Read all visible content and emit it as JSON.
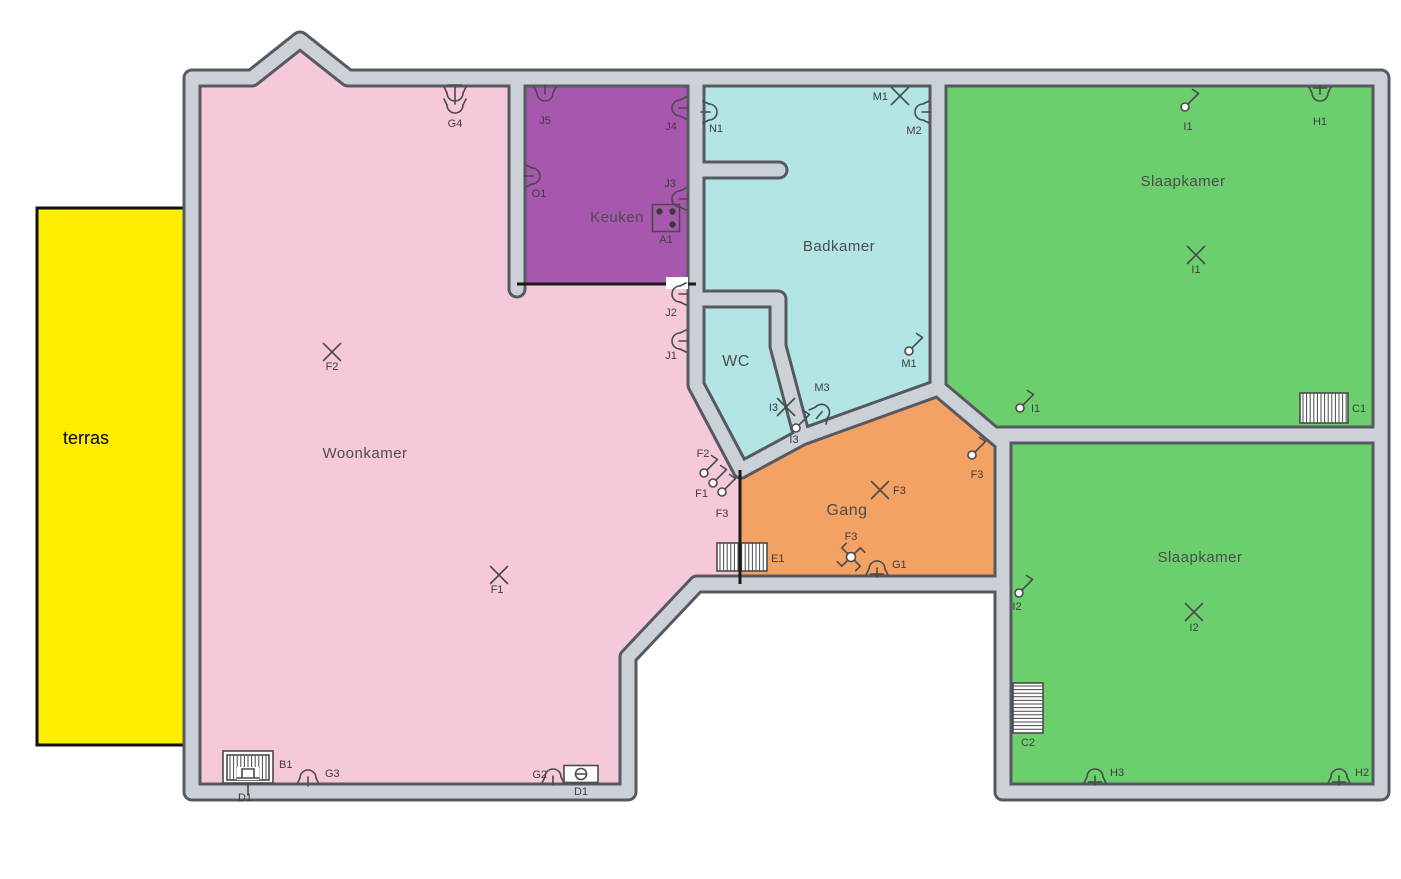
{
  "palette": {
    "background": "#ffffff",
    "wall_fill": "#ccd1d7",
    "wall_edge": "#565a60",
    "thin_wall": "#1a1a1a",
    "symbol_stroke": "#4a4a4a",
    "label_color": "#3d3d3d",
    "room_label_color": "#4c4c4c",
    "terras_label_color": "#000000"
  },
  "terras": {
    "label": "terras",
    "x": 37,
    "y": 208,
    "w": 149,
    "h": 537,
    "fill": "#fdee00",
    "border": "#111111",
    "label_x": 63,
    "label_y": 444,
    "label_size": 18
  },
  "rooms": [
    {
      "id": "woonkamer",
      "label": "Woonkamer",
      "fill": "#f6c9da",
      "label_x": 365,
      "label_y": 458,
      "fs": 15,
      "points": "192,78 252,78 300,40 348,78 517,78 517,284 696,284 696,385 741,471 741,584 697,584 628,657 628,792 192,792"
    },
    {
      "id": "keuken",
      "label": "Keuken",
      "fill": "#a857ae",
      "label_x": 617,
      "label_y": 222,
      "fs": 15,
      "points": "517,78 696,78 696,284 517,284"
    },
    {
      "id": "badkamer",
      "label": "Badkamer",
      "fill": "#b2e5e4",
      "label_x": 839,
      "label_y": 251,
      "fs": 15,
      "points": "696,78 938,78 938,390 802,437 779,348 779,299 696,299"
    },
    {
      "id": "wc",
      "label": "WC",
      "fill": "#b2e5e4",
      "label_x": 736,
      "label_y": 366,
      "fs": 16,
      "points": "696,299 779,299 779,348 802,437 741,471 696,385"
    },
    {
      "id": "gang",
      "label": "Gang",
      "fill": "#f4a263",
      "label_x": 847,
      "label_y": 515,
      "fs": 16,
      "points": "741,471 806,438 938,388 1003,446 1003,584 741,584"
    },
    {
      "id": "slaapkamer-1",
      "label": "Slaapkamer",
      "fill": "#6ccf6e",
      "label_x": 1183,
      "label_y": 186,
      "fs": 15,
      "points": "938,78 1381,78 1381,435 1003,440 938,388"
    },
    {
      "id": "slaapkamer-2",
      "label": "Slaapkamer",
      "fill": "#6ccf6e",
      "label_x": 1200,
      "label_y": 562,
      "fs": 15,
      "points": "1003,437 1381,437 1381,792 1003,792"
    }
  ],
  "walls": {
    "thick": [
      "M192,78 H252 L300,40 L348,78 H1381 V792 H1003 V584 H697 L628,657 V792 H192 Z",
      "M517,78 V289",
      "M696,78 V385 L741,470",
      "M696,299 H778 V346 L802,437",
      "M741,470 L802,437",
      "M802,437 L938,388",
      "M938,388 L1002,442",
      "M938,78 V389",
      "M997,435 H1381",
      "M1003,435 V792",
      "M699,170 H779"
    ],
    "thin": [
      "M517,284 H696",
      "M740,470 V584"
    ],
    "gaps": [
      {
        "x": 666,
        "y": 277,
        "w": 22,
        "h": 12
      }
    ]
  },
  "symbols": [
    {
      "id": "G4",
      "type": "socket-double",
      "x": 455,
      "y": 100,
      "rot": 0,
      "label": "G4",
      "lx": 455,
      "ly": 127,
      "la": "m"
    },
    {
      "id": "F2-lamp",
      "type": "lamp",
      "x": 332,
      "y": 352,
      "rot": 0,
      "label": "F2",
      "lx": 332,
      "ly": 370,
      "la": "m"
    },
    {
      "id": "F1-lamp",
      "type": "lamp",
      "x": 499,
      "y": 575,
      "rot": 0,
      "label": "F1",
      "lx": 497,
      "ly": 593,
      "la": "m"
    },
    {
      "id": "B1",
      "type": "boiler",
      "x": 248,
      "y": 767,
      "rot": 0,
      "label": "B1",
      "lx": 279,
      "ly": 768,
      "la": "s"
    },
    {
      "id": "D1-boiler",
      "type": "label-only",
      "x": 245,
      "y": 801,
      "rot": 0,
      "label": "D1",
      "lx": 245,
      "ly": 801,
      "la": "m"
    },
    {
      "id": "G3",
      "type": "socket",
      "x": 308,
      "y": 771,
      "rot": 180,
      "label": "G3",
      "lx": 325,
      "ly": 777,
      "la": "s"
    },
    {
      "id": "G2",
      "type": "socket",
      "x": 553,
      "y": 770,
      "rot": 180,
      "label": "G2",
      "lx": 547,
      "ly": 778,
      "la": "e"
    },
    {
      "id": "D1-box",
      "type": "thermostat",
      "x": 581,
      "y": 774,
      "rot": 0,
      "label": "D1",
      "lx": 581,
      "ly": 795,
      "la": "m"
    },
    {
      "id": "F2-switch",
      "type": "switch",
      "x": 704,
      "y": 473,
      "rot": 0,
      "label": "F2",
      "lx": 703,
      "ly": 457,
      "la": "m"
    },
    {
      "id": "F1-switch",
      "type": "switch",
      "x": 713,
      "y": 483,
      "rot": 0,
      "label": "F1",
      "lx": 708,
      "ly": 497,
      "la": "e"
    },
    {
      "id": "F3-switch-a",
      "type": "switch",
      "x": 722,
      "y": 492,
      "rot": 0,
      "label": "F3",
      "lx": 722,
      "ly": 517,
      "la": "m"
    },
    {
      "id": "J5",
      "type": "socket",
      "x": 545,
      "y": 100,
      "rot": 0,
      "label": "J5",
      "lx": 545,
      "ly": 124,
      "la": "m"
    },
    {
      "id": "J4",
      "type": "socket",
      "x": 673,
      "y": 108,
      "rot": 90,
      "label": "J4",
      "lx": 671,
      "ly": 130,
      "la": "m"
    },
    {
      "id": "O1",
      "type": "socket",
      "x": 539,
      "y": 176,
      "rot": -90,
      "label": "O1",
      "lx": 539,
      "ly": 197,
      "la": "m"
    },
    {
      "id": "J3",
      "type": "socket",
      "x": 673,
      "y": 199,
      "rot": 90,
      "label": "J3",
      "lx": 670,
      "ly": 187,
      "la": "m"
    },
    {
      "id": "A1",
      "type": "stove",
      "x": 666,
      "y": 218,
      "rot": 0,
      "label": "A1",
      "lx": 666,
      "ly": 243,
      "la": "m"
    },
    {
      "id": "J2",
      "type": "socket",
      "x": 673,
      "y": 294,
      "rot": 90,
      "label": "J2",
      "lx": 671,
      "ly": 316,
      "la": "m"
    },
    {
      "id": "J1",
      "type": "socket",
      "x": 673,
      "y": 341,
      "rot": 90,
      "label": "J1",
      "lx": 671,
      "ly": 359,
      "la": "m"
    },
    {
      "id": "N1",
      "type": "socket",
      "x": 716,
      "y": 112,
      "rot": -90,
      "label": "N1",
      "lx": 716,
      "ly": 132,
      "la": "m"
    },
    {
      "id": "M1-lamp",
      "type": "lamp",
      "x": 900,
      "y": 96,
      "rot": 0,
      "label": "M1",
      "lx": 888,
      "ly": 100,
      "la": "e"
    },
    {
      "id": "M2",
      "type": "socket",
      "x": 916,
      "y": 112,
      "rot": 90,
      "label": "M2",
      "lx": 914,
      "ly": 134,
      "la": "m"
    },
    {
      "id": "M1-switch",
      "type": "switch",
      "x": 909,
      "y": 351,
      "rot": 0,
      "label": "M1",
      "lx": 909,
      "ly": 367,
      "la": "m"
    },
    {
      "id": "M3",
      "type": "socket",
      "x": 826,
      "y": 407,
      "rot": 220,
      "label": "M3",
      "lx": 822,
      "ly": 391,
      "la": "m"
    },
    {
      "id": "I3-lamp",
      "type": "lamp",
      "x": 786,
      "y": 407,
      "rot": 0,
      "label": "I3",
      "lx": 778,
      "ly": 411,
      "la": "e"
    },
    {
      "id": "I3-switch",
      "type": "switch",
      "x": 796,
      "y": 428,
      "rot": 0,
      "label": "I3",
      "lx": 794,
      "ly": 443,
      "la": "m"
    },
    {
      "id": "F3-lamp",
      "type": "lamp",
      "x": 880,
      "y": 490,
      "rot": 0,
      "label": "F3",
      "lx": 893,
      "ly": 494,
      "la": "s"
    },
    {
      "id": "F3-switch-b",
      "type": "switch",
      "x": 972,
      "y": 455,
      "rot": 0,
      "label": "F3",
      "lx": 977,
      "ly": 478,
      "la": "m"
    },
    {
      "id": "F3-cross",
      "type": "switch-cross",
      "x": 851,
      "y": 557,
      "rot": 0,
      "label": "F3",
      "lx": 851,
      "ly": 540,
      "la": "m"
    },
    {
      "id": "G1",
      "type": "socket-earthed",
      "x": 877,
      "y": 562,
      "rot": 180,
      "label": "G1",
      "lx": 892,
      "ly": 568,
      "la": "s"
    },
    {
      "id": "E1",
      "type": "radiator-v",
      "x": 742,
      "y": 557,
      "w": 50,
      "h": 28,
      "div": -2,
      "rot": 0,
      "label": "E1",
      "lx": 771,
      "ly": 562,
      "la": "s"
    },
    {
      "id": "I1-switch-a",
      "type": "switch",
      "x": 1185,
      "y": 107,
      "rot": 0,
      "label": "I1",
      "lx": 1188,
      "ly": 130,
      "la": "m"
    },
    {
      "id": "H1",
      "type": "socket-earthed",
      "x": 1320,
      "y": 100,
      "rot": 0,
      "label": "H1",
      "lx": 1320,
      "ly": 125,
      "la": "m"
    },
    {
      "id": "I1-lamp",
      "type": "lamp",
      "x": 1196,
      "y": 255,
      "rot": 0,
      "label": "I1",
      "lx": 1196,
      "ly": 273,
      "la": "m"
    },
    {
      "id": "I1-switch-b",
      "type": "switch",
      "x": 1020,
      "y": 408,
      "rot": 0,
      "label": "I1",
      "lx": 1031,
      "ly": 412,
      "la": "s"
    },
    {
      "id": "C1",
      "type": "radiator-v",
      "x": 1324,
      "y": 408,
      "w": 48,
      "h": 30,
      "rot": 0,
      "label": "C1",
      "lx": 1352,
      "ly": 412,
      "la": "s"
    },
    {
      "id": "I2-switch",
      "type": "switch",
      "x": 1019,
      "y": 593,
      "rot": 0,
      "label": "I2",
      "lx": 1017,
      "ly": 610,
      "la": "m"
    },
    {
      "id": "I2-lamp",
      "type": "lamp",
      "x": 1194,
      "y": 612,
      "rot": 0,
      "label": "I2",
      "lx": 1194,
      "ly": 631,
      "la": "m"
    },
    {
      "id": "C2",
      "type": "radiator-h",
      "x": 1028,
      "y": 708,
      "w": 30,
      "h": 50,
      "rot": 0,
      "label": "C2",
      "lx": 1028,
      "ly": 746,
      "la": "m"
    },
    {
      "id": "H3",
      "type": "socket-earthed",
      "x": 1095,
      "y": 770,
      "rot": 180,
      "label": "H3",
      "lx": 1110,
      "ly": 776,
      "la": "s"
    },
    {
      "id": "H2",
      "type": "socket-earthed",
      "x": 1339,
      "y": 770,
      "rot": 180,
      "label": "H2",
      "lx": 1355,
      "ly": 776,
      "la": "s"
    }
  ]
}
